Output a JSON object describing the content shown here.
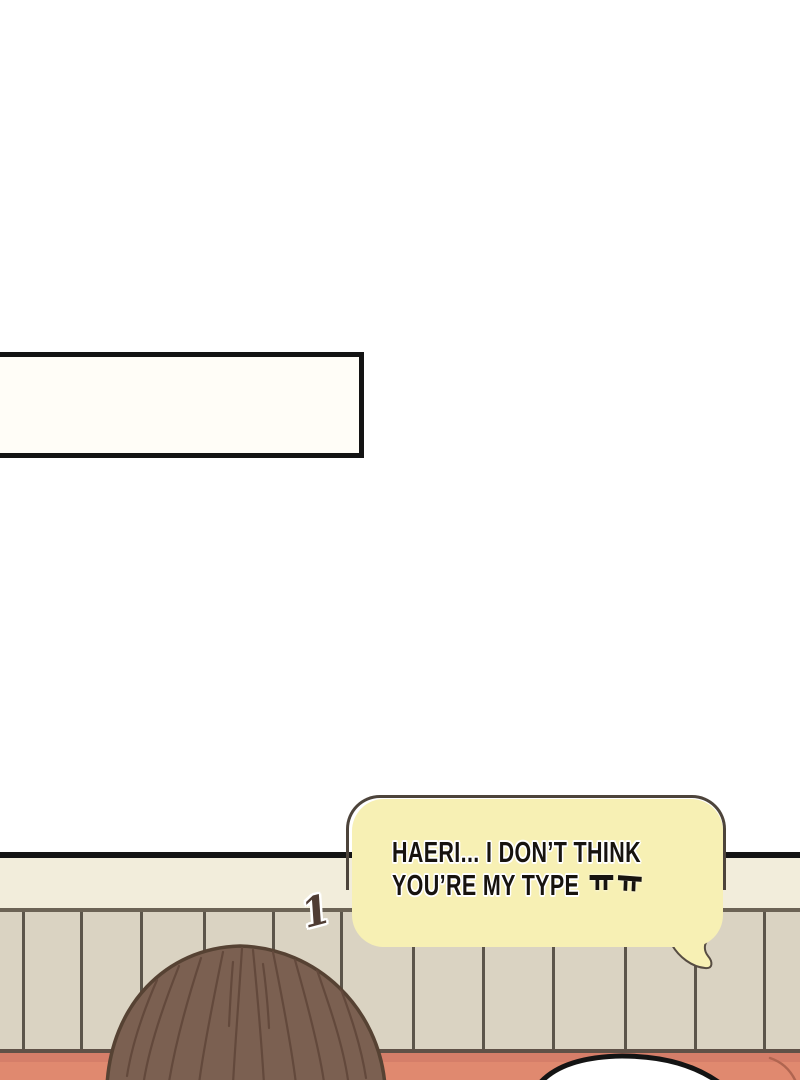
{
  "panel_number": "1",
  "speech_bubble": {
    "line1": "HAERI... I DON’T THINK",
    "line2": "YOU’RE MY TYPE",
    "emoticon": "ㅠㅠ"
  },
  "colors": {
    "page_bg": "#ffffff",
    "caption_box_fill": "#fffdf7",
    "caption_box_border": "#131313",
    "divider_line": "#141414",
    "wall_upper": "#f2eddb",
    "wall_rail": "#6c6355",
    "wall_planks": "#dad3c2",
    "plank_line": "#5c554a",
    "sofa": "#e0896f",
    "sofa_shadow": "#d57e69",
    "sofa_edge_line": "#5f5147",
    "sofa_seam": "#b06550",
    "hair_fill": "#7b6051",
    "hair_outline": "#564233",
    "hair_strand": "#63493c",
    "bubble_fill": "#f7f0b4",
    "bubble_outline": "#4d443b",
    "tail_outline": "#564c42",
    "white_bubble_fill": "#ffffff",
    "white_bubble_outline": "#141414",
    "number_color": "#4f3c33",
    "text_color": "#17130f"
  }
}
